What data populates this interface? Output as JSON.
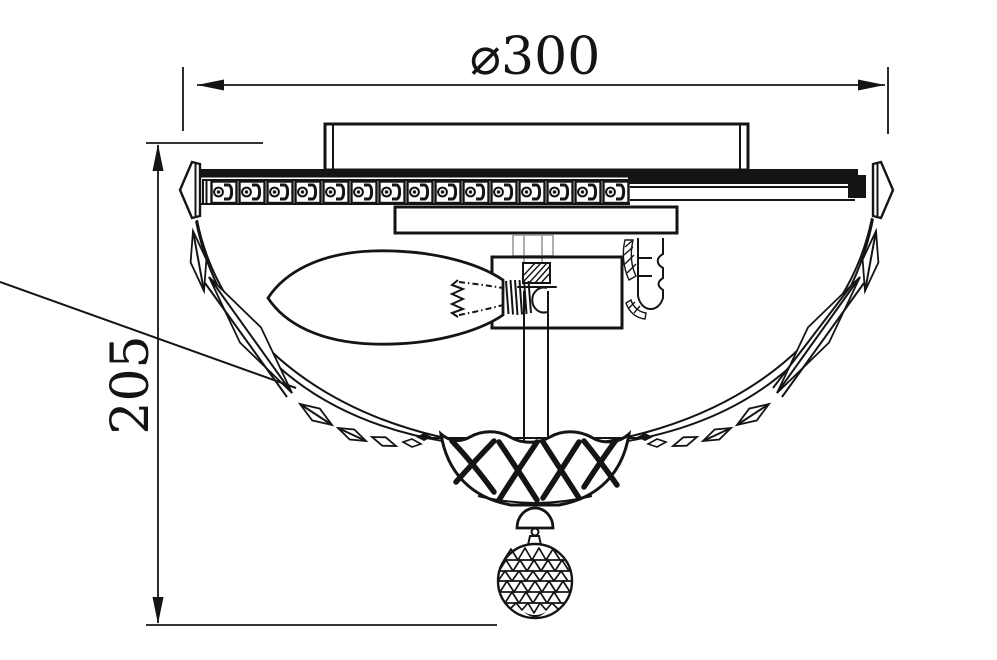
{
  "drawing": {
    "type": "technical-dimension-drawing",
    "subject": "ceiling-light-fixture-side-view",
    "background_color": "#ffffff",
    "line_color": "#141414",
    "dimensions": {
      "diameter": "⌀300",
      "height": "205"
    }
  }
}
